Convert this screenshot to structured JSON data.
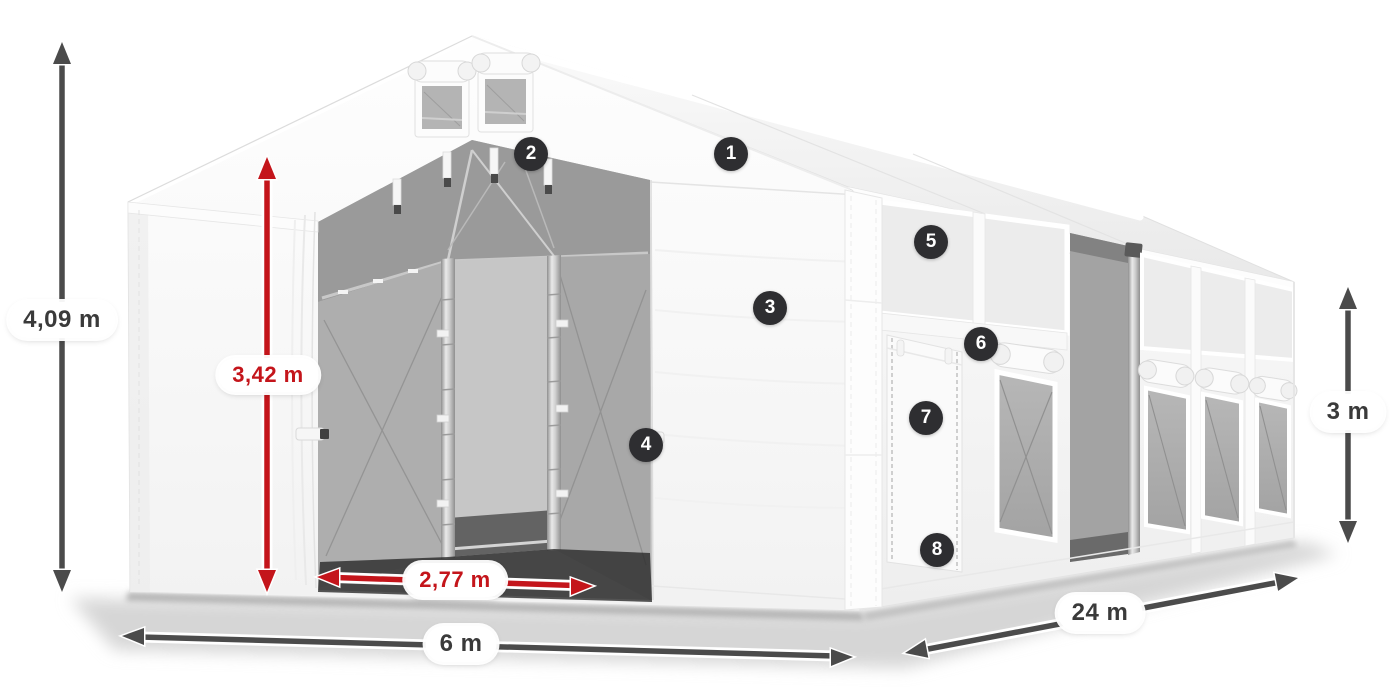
{
  "diagram": {
    "dimensions": {
      "total_height": {
        "label": "4,09 m",
        "color": "#4b4b4b"
      },
      "entrance_height": {
        "label": "3,42 m",
        "color": "#c4151b"
      },
      "entrance_width": {
        "label": "2,77 m",
        "color": "#c4151b"
      },
      "front_width": {
        "label": "6 m",
        "color": "#4b4b4b"
      },
      "side_length": {
        "label": "24 m",
        "color": "#4b4b4b"
      },
      "side_wall_height": {
        "label": "3 m",
        "color": "#4b4b4b"
      }
    },
    "callouts": [
      {
        "number": "1"
      },
      {
        "number": "2"
      },
      {
        "number": "3"
      },
      {
        "number": "4"
      },
      {
        "number": "5"
      },
      {
        "number": "6"
      },
      {
        "number": "7"
      },
      {
        "number": "8"
      }
    ],
    "colors": {
      "background": "#ffffff",
      "dimension_dark": "#4b4b4b",
      "dimension_red": "#c4151b",
      "badge_background": "#2e2e31",
      "badge_text": "#ffffff",
      "label_background": "#ffffff"
    }
  }
}
